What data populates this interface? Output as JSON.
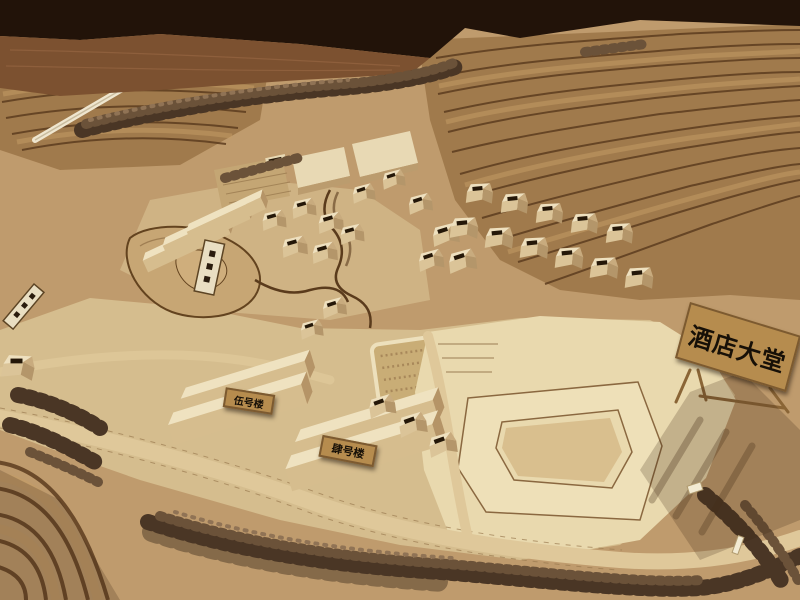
{
  "photo": {
    "subject": "wooden architectural scale model of a hillside resort village",
    "signs": {
      "hotel_lobby": "酒店大堂",
      "building_no5": "伍号楼",
      "building_no4": "肆号楼"
    },
    "colors": {
      "background": "#221309",
      "wood_floor": "#7c5130",
      "terrain_base": "#bf9b6d",
      "terrain_flat": "#d5bd8e",
      "plaza": "#e9d9ae",
      "hill": "#a07a4c",
      "contour_dark": "#5c3c1f",
      "contour_light": "#c59e66",
      "trees_dark": "#4a3625",
      "trees_mid": "#6b5239",
      "road": "#dfc89a",
      "sign_bg": "#b68c4e",
      "sign_text": "#171007"
    }
  }
}
